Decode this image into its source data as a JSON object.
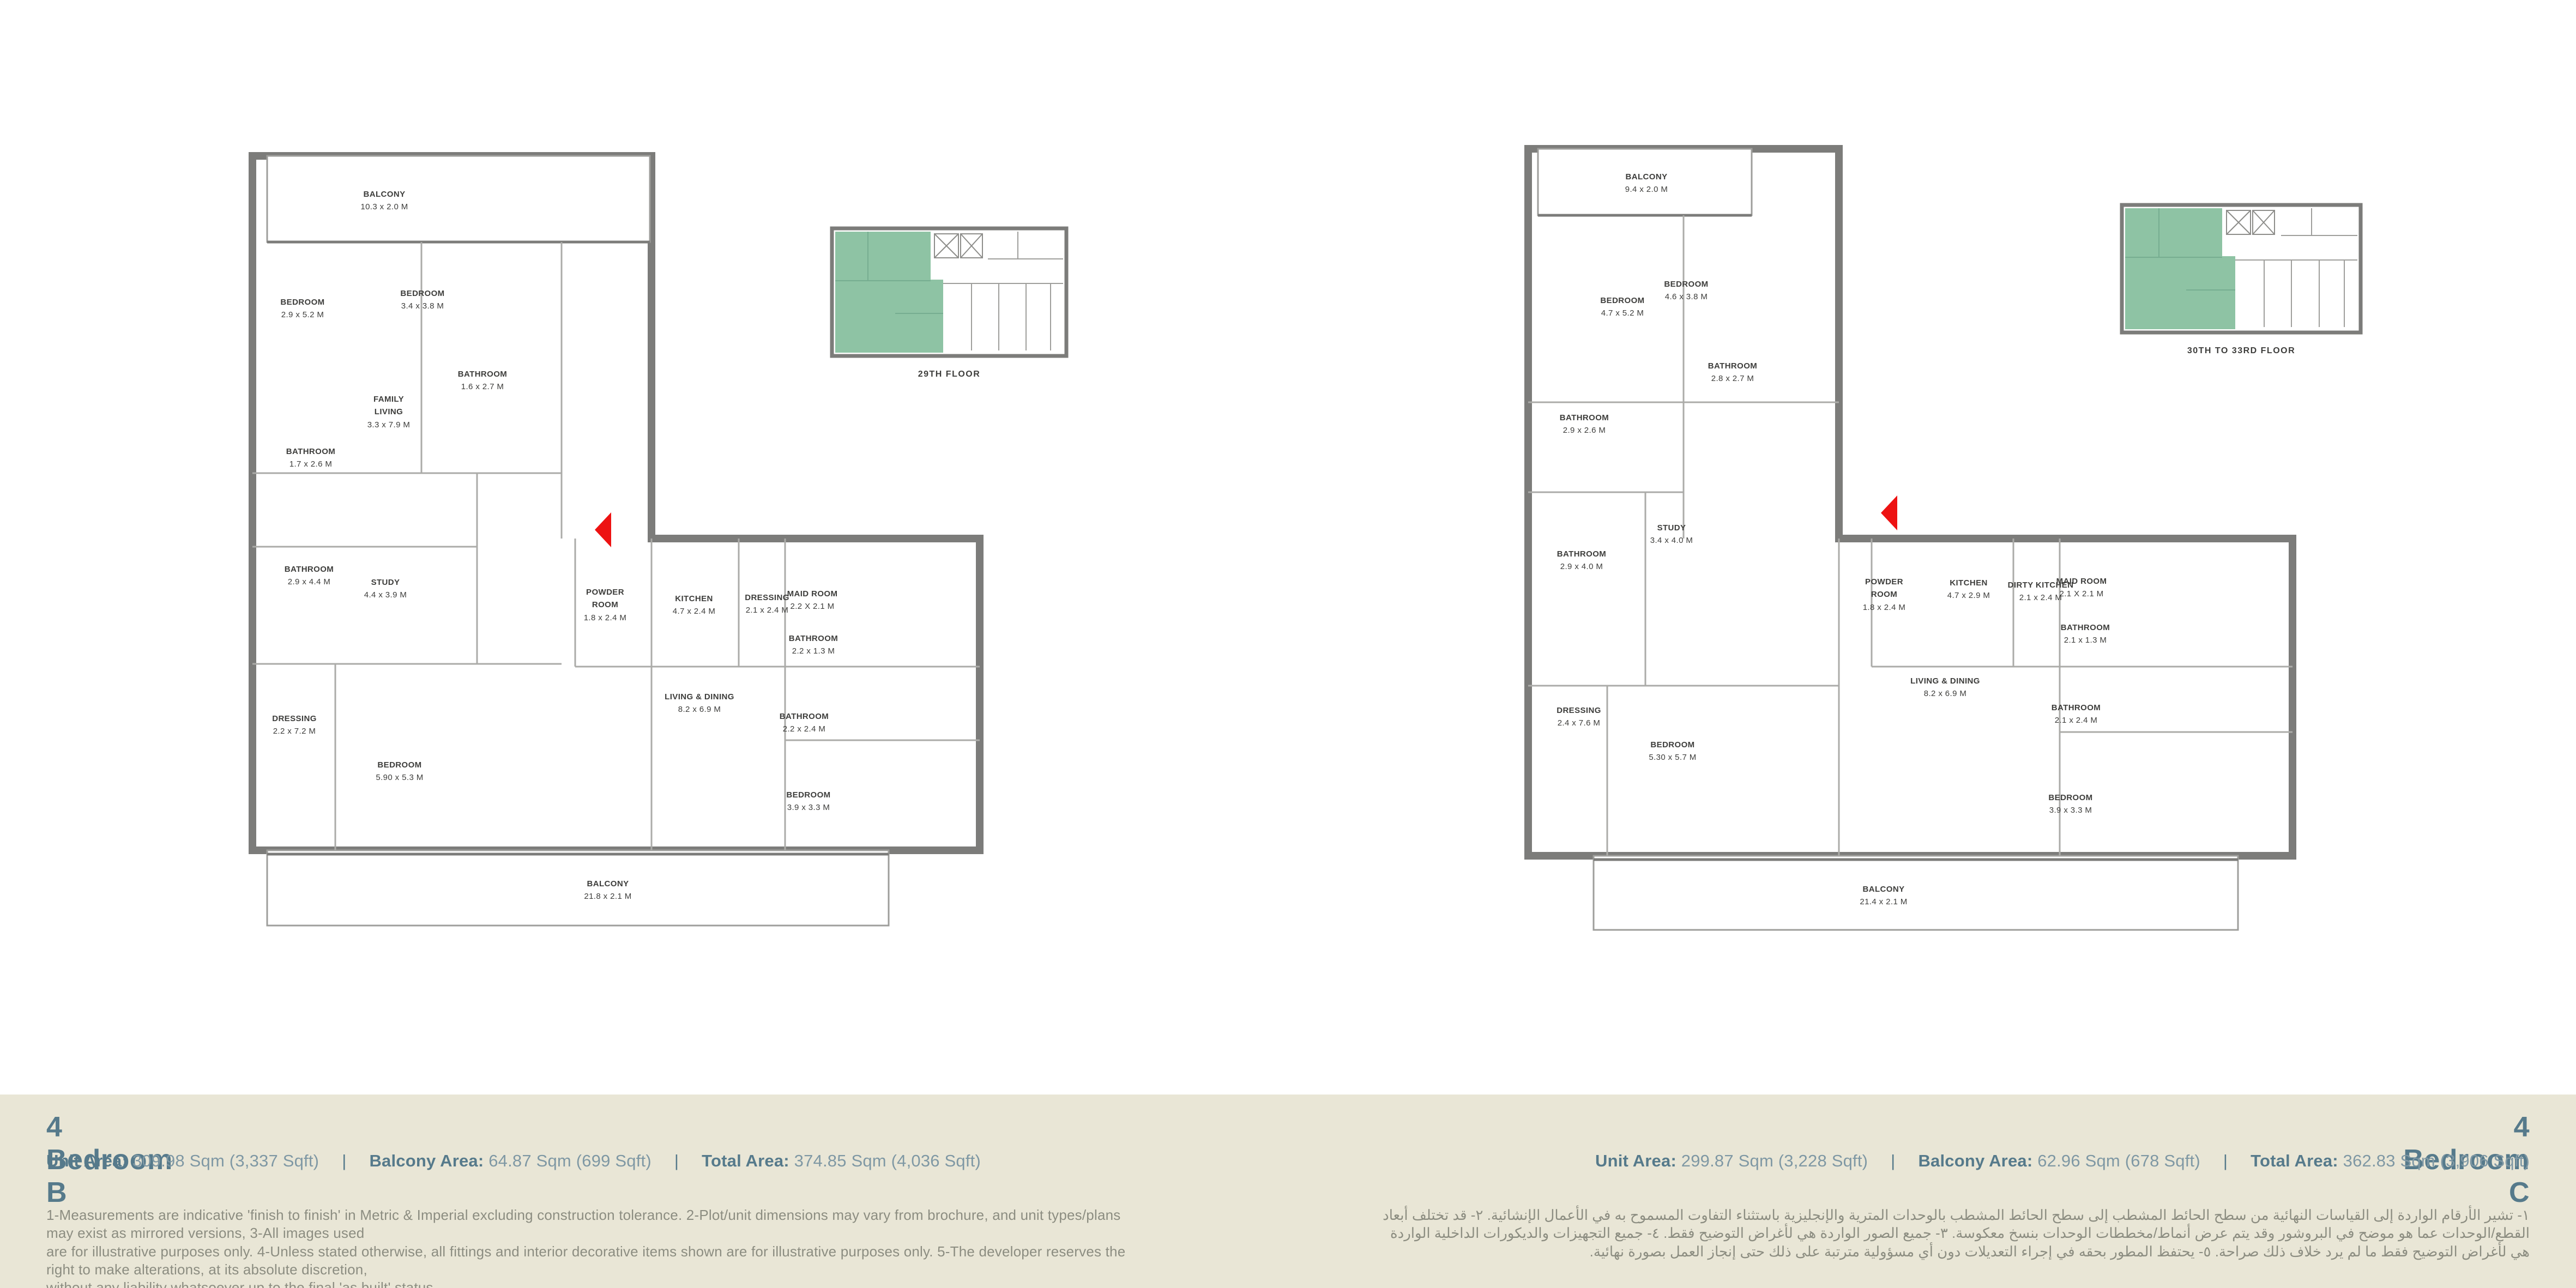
{
  "colors": {
    "wall": "#7c7c7a",
    "partition": "#ababa8",
    "green": "#8ec3a4",
    "beige": "#e9e6d6",
    "slate": "#567a8b",
    "value": "#7f98a4",
    "disclaimer_text": "#8c8d81",
    "red": "#ed1212"
  },
  "plans": [
    {
      "id": "B",
      "key_plan_label": "29TH FLOOR",
      "rooms": [
        {
          "name": "BALCONY",
          "dim": "10.3 x 2.0 M"
        },
        {
          "name": "BEDROOM",
          "dim": "2.9 x 5.2 M"
        },
        {
          "name": "BEDROOM",
          "dim": "3.4 x 3.8 M"
        },
        {
          "name": "BATHROOM",
          "dim": "1.6 x 2.7 M"
        },
        {
          "name": "FAMILY LIVING",
          "dim": "3.3 x 7.9 M"
        },
        {
          "name": "BATHROOM",
          "dim": "1.7 x 2.6 M"
        },
        {
          "name": "BATHROOM",
          "dim": "2.9 x 4.4 M"
        },
        {
          "name": "STUDY",
          "dim": "4.4 x 3.9 M"
        },
        {
          "name": "POWDER ROOM",
          "dim": "1.8 x 2.4 M"
        },
        {
          "name": "KITCHEN",
          "dim": "4.7 x 2.4 M"
        },
        {
          "name": "DRESSING",
          "dim": "2.1 x 2.4 M"
        },
        {
          "name": "MAID ROOM",
          "dim": "2.2 X 2.1 M"
        },
        {
          "name": "BATHROOM",
          "dim": "2.2 x 1.3 M"
        },
        {
          "name": "LIVING & DINING",
          "dim": "8.2 x 6.9 M"
        },
        {
          "name": "BATHROOM",
          "dim": "2.2 x 2.4 M"
        },
        {
          "name": "DRESSING",
          "dim": "2.2 x 7.2 M"
        },
        {
          "name": "BEDROOM",
          "dim": "5.90 x 5.3 M"
        },
        {
          "name": "BEDROOM",
          "dim": "3.9 x 3.3 M"
        },
        {
          "name": "BALCONY",
          "dim": "21.8 x 2.1 M"
        }
      ]
    },
    {
      "id": "C",
      "key_plan_label": "30TH TO 33RD FLOOR",
      "rooms": [
        {
          "name": "BALCONY",
          "dim": "9.4 x 2.0 M"
        },
        {
          "name": "BEDROOM",
          "dim": "4.7 x 5.2 M"
        },
        {
          "name": "BEDROOM",
          "dim": "4.6 x 3.8 M"
        },
        {
          "name": "BATHROOM",
          "dim": "2.8 x 2.7 M"
        },
        {
          "name": "BATHROOM",
          "dim": "2.9 x 2.6 M"
        },
        {
          "name": "BATHROOM",
          "dim": "2.9 x 4.0 M"
        },
        {
          "name": "STUDY",
          "dim": "3.4 x 4.0 M"
        },
        {
          "name": "POWDER ROOM",
          "dim": "1.8 x 2.4 M"
        },
        {
          "name": "KITCHEN",
          "dim": "4.7 x 2.9 M"
        },
        {
          "name": "DIRTY KITCHEN",
          "dim": "2.1 x 2.4 M"
        },
        {
          "name": "MAID ROOM",
          "dim": "2.1 X 2.1 M"
        },
        {
          "name": "BATHROOM",
          "dim": "2.1 x 1.3 M"
        },
        {
          "name": "LIVING & DINING",
          "dim": "8.2 x 6.9 M"
        },
        {
          "name": "BATHROOM",
          "dim": "2.1 x 2.4 M"
        },
        {
          "name": "DRESSING",
          "dim": "2.4 x 7.6 M"
        },
        {
          "name": "BEDROOM",
          "dim": "5.30 x 5.7 M"
        },
        {
          "name": "BEDROOM",
          "dim": "3.9 x 3.3 M"
        },
        {
          "name": "BALCONY",
          "dim": "21.4 x 2.1 M"
        }
      ]
    }
  ],
  "footer": {
    "sep": "|",
    "left": {
      "title": "4 Bedroom B",
      "stats": [
        {
          "label": "Unit Area:",
          "value": "309.98 Sqm (3,337 Sqft)"
        },
        {
          "label": "Balcony Area:",
          "value": "64.87 Sqm (699 Sqft)"
        },
        {
          "label": "Total Area:",
          "value": "374.85 Sqm (4,036 Sqft)"
        }
      ],
      "disclaimer_lines": [
        "1-Measurements are indicative 'finish to finish' in Metric & Imperial excluding construction tolerance. 2-Plot/unit dimensions may vary from brochure, and unit types/plans may exist as mirrored versions, 3-All images used",
        "are for illustrative purposes only. 4-Unless stated otherwise, all fittings and interior decorative items shown are for illustrative purposes only. 5-The developer reserves the right to make alterations, at its absolute discretion,",
        "without any liability whatsoever up to the final 'as built' status."
      ]
    },
    "right": {
      "title": "4 Bedroom C",
      "stats": [
        {
          "label": "Unit Area:",
          "value": "299.87 Sqm (3,228 Sqft)"
        },
        {
          "label": "Balcony Area:",
          "value": "62.96 Sqm (678 Sqft)"
        },
        {
          "label": "Total Area:",
          "value": "362.83 Sqm (3,906 Sqft)"
        }
      ],
      "disclaimer_ar": "١- تشير الأرقام الواردة إلى القياسات النهائية من سطح الحائط المشطب إلى سطح الحائط المشطب بالوحدات المترية والإنجليزية باستثناء التفاوت المسموح به في الأعمال الإنشائية. ٢- قد تختلف أبعاد القطع/الوحدات عما هو موضح في البروشور وقد يتم عرض أنماط/مخططات الوحدات بنسخ معكوسة. ٣- جميع الصور الواردة هي لأغراض التوضيح فقط. ٤- جميع التجهيزات والديكورات الداخلية الواردة هي لأغراض التوضيح فقط ما لم يرد خلاف ذلك صراحة. ٥- يحتفظ المطور بحقه في إجراء التعديلات دون أي مسؤولية مترتبة على ذلك حتى إنجاز العمل بصورة نهائية."
    }
  }
}
